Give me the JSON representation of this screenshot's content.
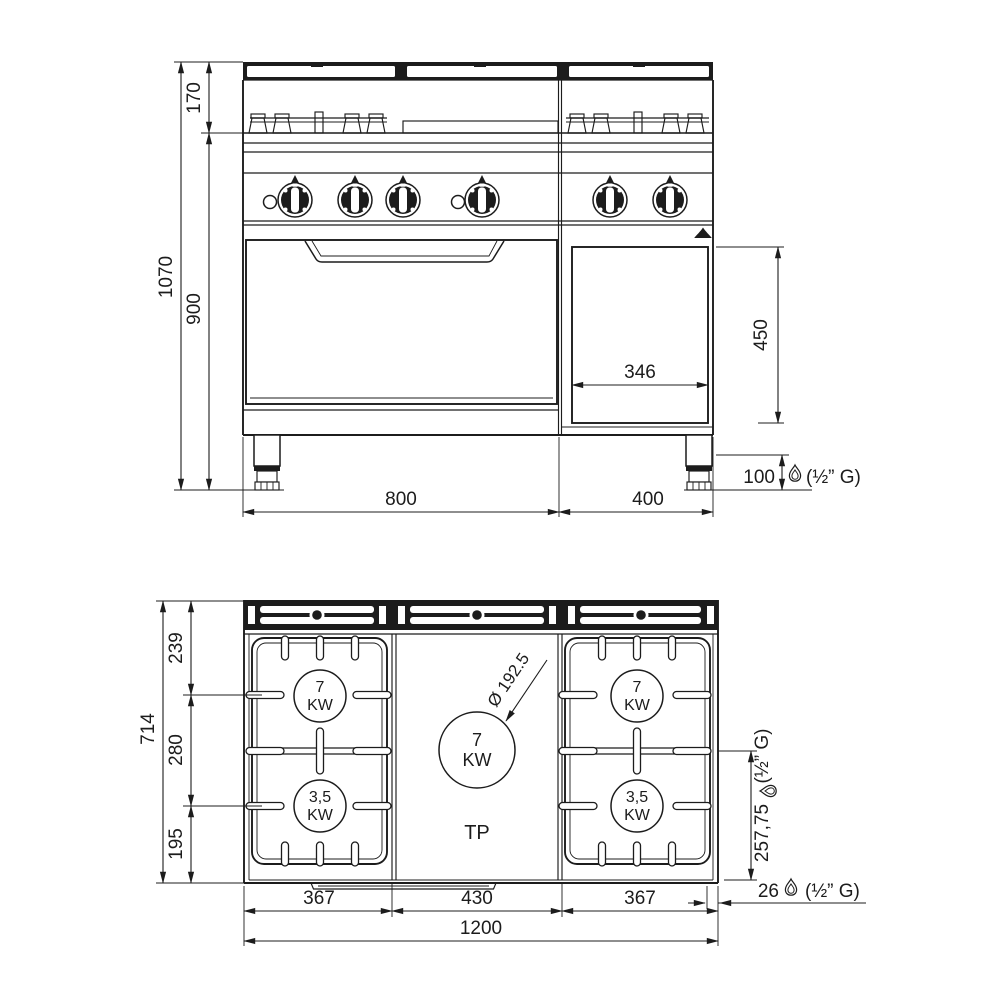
{
  "front_view": {
    "dim_backsplash_height": "170",
    "dim_total_height": "1070",
    "dim_worktop_height": "900",
    "dim_left_module_width": "800",
    "dim_right_module_width": "400",
    "dim_compartment_width": "346",
    "dim_compartment_height": "450",
    "dim_foot_height": "100",
    "gas_connection_note": "(½” G)"
  },
  "top_view": {
    "dim_rear_to_burner_axis": "239",
    "dim_burner_axis_spacing": "280",
    "dim_burner_axis_to_front": "195",
    "dim_total_depth": "714",
    "dim_left_module_width": "367",
    "dim_center_module_width": "430",
    "dim_right_module_width": "367",
    "dim_total_width": "1200",
    "dim_gas_from_front": "257,75",
    "dim_gas_from_right": "26",
    "gas_note_vertical": "(½” G)",
    "gas_note_bottom": "(½” G)",
    "plate_diameter": "Ø 192.5",
    "plate_label": "TP",
    "burners": {
      "left_rear_power": "7",
      "left_rear_unit": "KW",
      "left_front_power": "3,5",
      "left_front_unit": "KW",
      "center_power": "7",
      "center_unit": "KW",
      "right_rear_power": "7",
      "right_rear_unit": "KW",
      "right_front_power": "3,5",
      "right_front_unit": "KW"
    }
  }
}
